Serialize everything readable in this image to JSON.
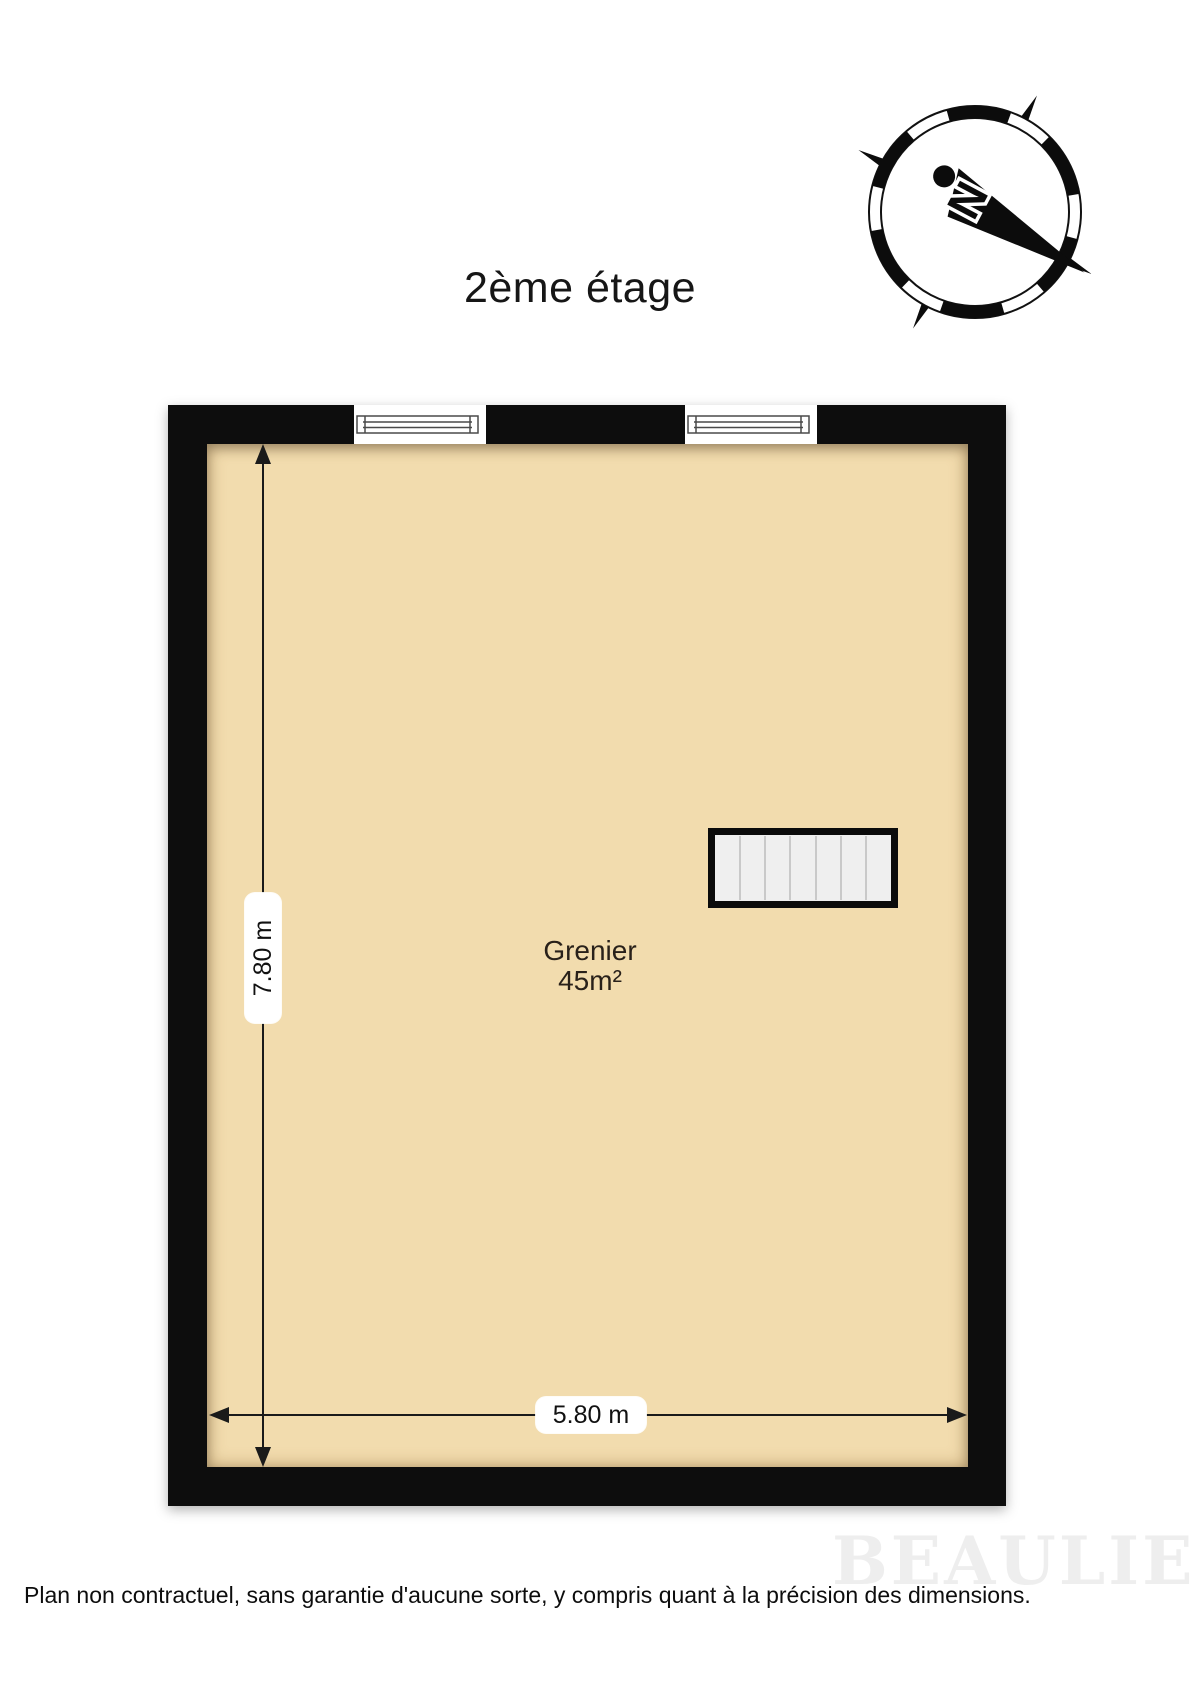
{
  "header": {
    "title": "2ème étage"
  },
  "compass": {
    "north_label": "N"
  },
  "floor_plan": {
    "room": {
      "name": "Grenier",
      "area": "45m²"
    },
    "dimensions": {
      "vertical": "7.80 m",
      "horizontal": "5.80 m"
    },
    "features": [
      "window",
      "window",
      "staircase"
    ]
  },
  "footer": {
    "disclaimer": "Plan non contractuel, sans garantie d'aucune sorte, y compris quant à la précision des dimensions."
  },
  "watermark": "BEAULIEU",
  "colors": {
    "floor": "#F2DCAE",
    "wall": "#0B0B0B",
    "stair_fill": "#EFEFEF",
    "dimension": "#1A1A1A"
  }
}
